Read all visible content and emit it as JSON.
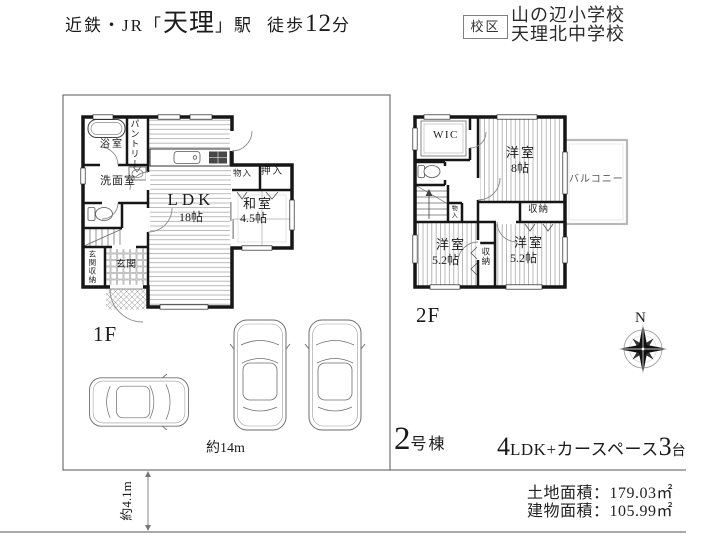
{
  "header": {
    "station": {
      "line_prefix": "近鉄・JR「",
      "station_name": "天理",
      "station_suffix": "」駅",
      "walk_prefix": "徒歩",
      "walk_minutes": "12",
      "walk_suffix": "分"
    },
    "school_district": {
      "label": "校区",
      "elementary": "山の辺小学校",
      "junior_high": "天理北中学校"
    }
  },
  "plan_1f": {
    "floor_label": "1F",
    "bath": "浴室",
    "pantry": "パントリー",
    "washroom": "洗面室",
    "ldk": "LDK",
    "ldk_size": "18帖",
    "storage_small": "物入",
    "closet": "押入",
    "japanese_room": "和室",
    "japanese_room_size": "4.5帖",
    "entrance": "玄関",
    "entrance_storage": "玄関収納"
  },
  "plan_2f": {
    "floor_label": "2F",
    "wic": "WIC",
    "bedroom_main": "洋室",
    "bedroom_main_size": "8帖",
    "balcony": "バルコニー",
    "storage_a": "収納",
    "storage_b": "収納",
    "storage_c": "物入",
    "bedroom_left": "洋室",
    "bedroom_left_size": "5.2帖",
    "bedroom_right": "洋室",
    "bedroom_right_size": "5.2帖"
  },
  "site": {
    "frontage": "約14m",
    "depth": "約4.1m",
    "compass_north": "N"
  },
  "unit": {
    "number": "2",
    "number_suffix": "号棟",
    "layout_number": "4",
    "layout_text": "LDK+カースペース",
    "car_count": "3",
    "car_unit": "台"
  },
  "areas": {
    "land": "土地面積：179.03㎡",
    "building": "建物面積：105.99㎡"
  }
}
